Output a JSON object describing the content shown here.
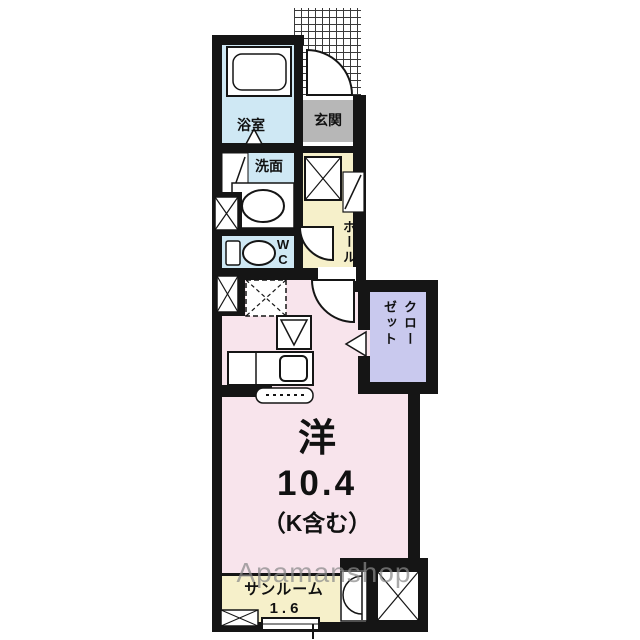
{
  "plan": {
    "bathroom": {
      "label": "浴室"
    },
    "entrance": {
      "label": "玄関"
    },
    "washroom": {
      "label": "洗面"
    },
    "wc": {
      "label": "WC"
    },
    "hall": {
      "label": "ホール"
    },
    "closet": {
      "label": "クローゼット"
    },
    "room": {
      "label": "洋",
      "size": "10.4",
      "note": "（K含む）"
    },
    "sunroom": {
      "label": "サンルーム",
      "size": "1.6"
    }
  },
  "watermark": {
    "text": "Apamanshop"
  },
  "colors": {
    "wall": "#151515",
    "wet_area": "#cfe8f4",
    "entrance_floor": "#b7b7b7",
    "hall_floor": "#f6f0ca",
    "room_floor": "#f8e4ec",
    "closet_floor": "#c9c9ee",
    "watermark_gray": "#8a8a8a"
  }
}
